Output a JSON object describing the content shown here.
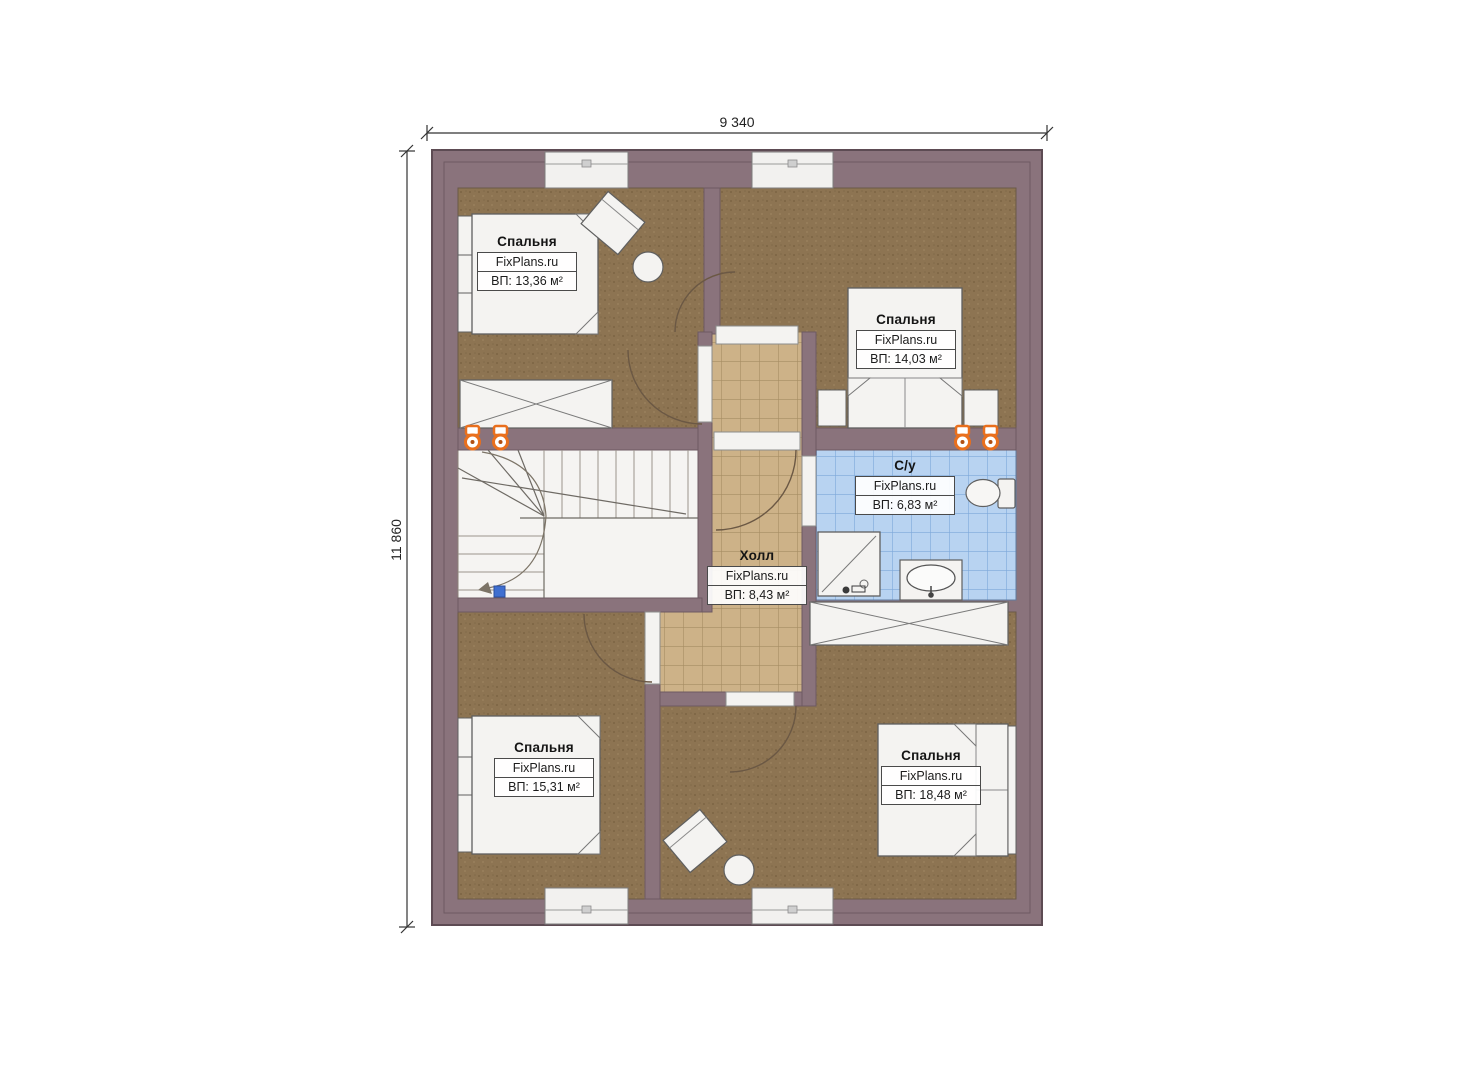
{
  "plan": {
    "type": "floor-plan",
    "dimensions": {
      "width_mm": "9 340",
      "height_mm": "11 860"
    },
    "branding": "FixPlans.ru",
    "rooms": [
      {
        "id": "bedroom-top-left",
        "name": "Спальня",
        "brand": "FixPlans.ru",
        "area": "ВП: 13,36 м²"
      },
      {
        "id": "bedroom-top-right",
        "name": "Спальня",
        "brand": "FixPlans.ru",
        "area": "ВП: 14,03 м²"
      },
      {
        "id": "bathroom",
        "name": "С/у",
        "brand": "FixPlans.ru",
        "area": "ВП: 6,83 м²"
      },
      {
        "id": "hall",
        "name": "Холл",
        "brand": "FixPlans.ru",
        "area": "ВП: 8,43 м²"
      },
      {
        "id": "bedroom-bottom-left",
        "name": "Спальня",
        "brand": "FixPlans.ru",
        "area": "ВП: 15,31 м²"
      },
      {
        "id": "bedroom-bottom-right",
        "name": "Спальня",
        "brand": "FixPlans.ru",
        "area": "ВП: 18,48 м²"
      }
    ],
    "icons": [
      "radiator-icon",
      "shower",
      "sink",
      "toilet",
      "bed",
      "wardrobe",
      "desk",
      "stool",
      "staircase",
      "window",
      "door-arc"
    ],
    "colors": {
      "wall": "#8a737c",
      "wall_outline": "#5d4b53",
      "floor_wood": "#8d7452",
      "tile_hall": "#cdb288",
      "tile_bath": "#b8d3f1",
      "furniture_white": "#f4f3f1",
      "radiator_orange": "#e96f1d",
      "stair_marker_blue": "#3f6fd0"
    }
  }
}
